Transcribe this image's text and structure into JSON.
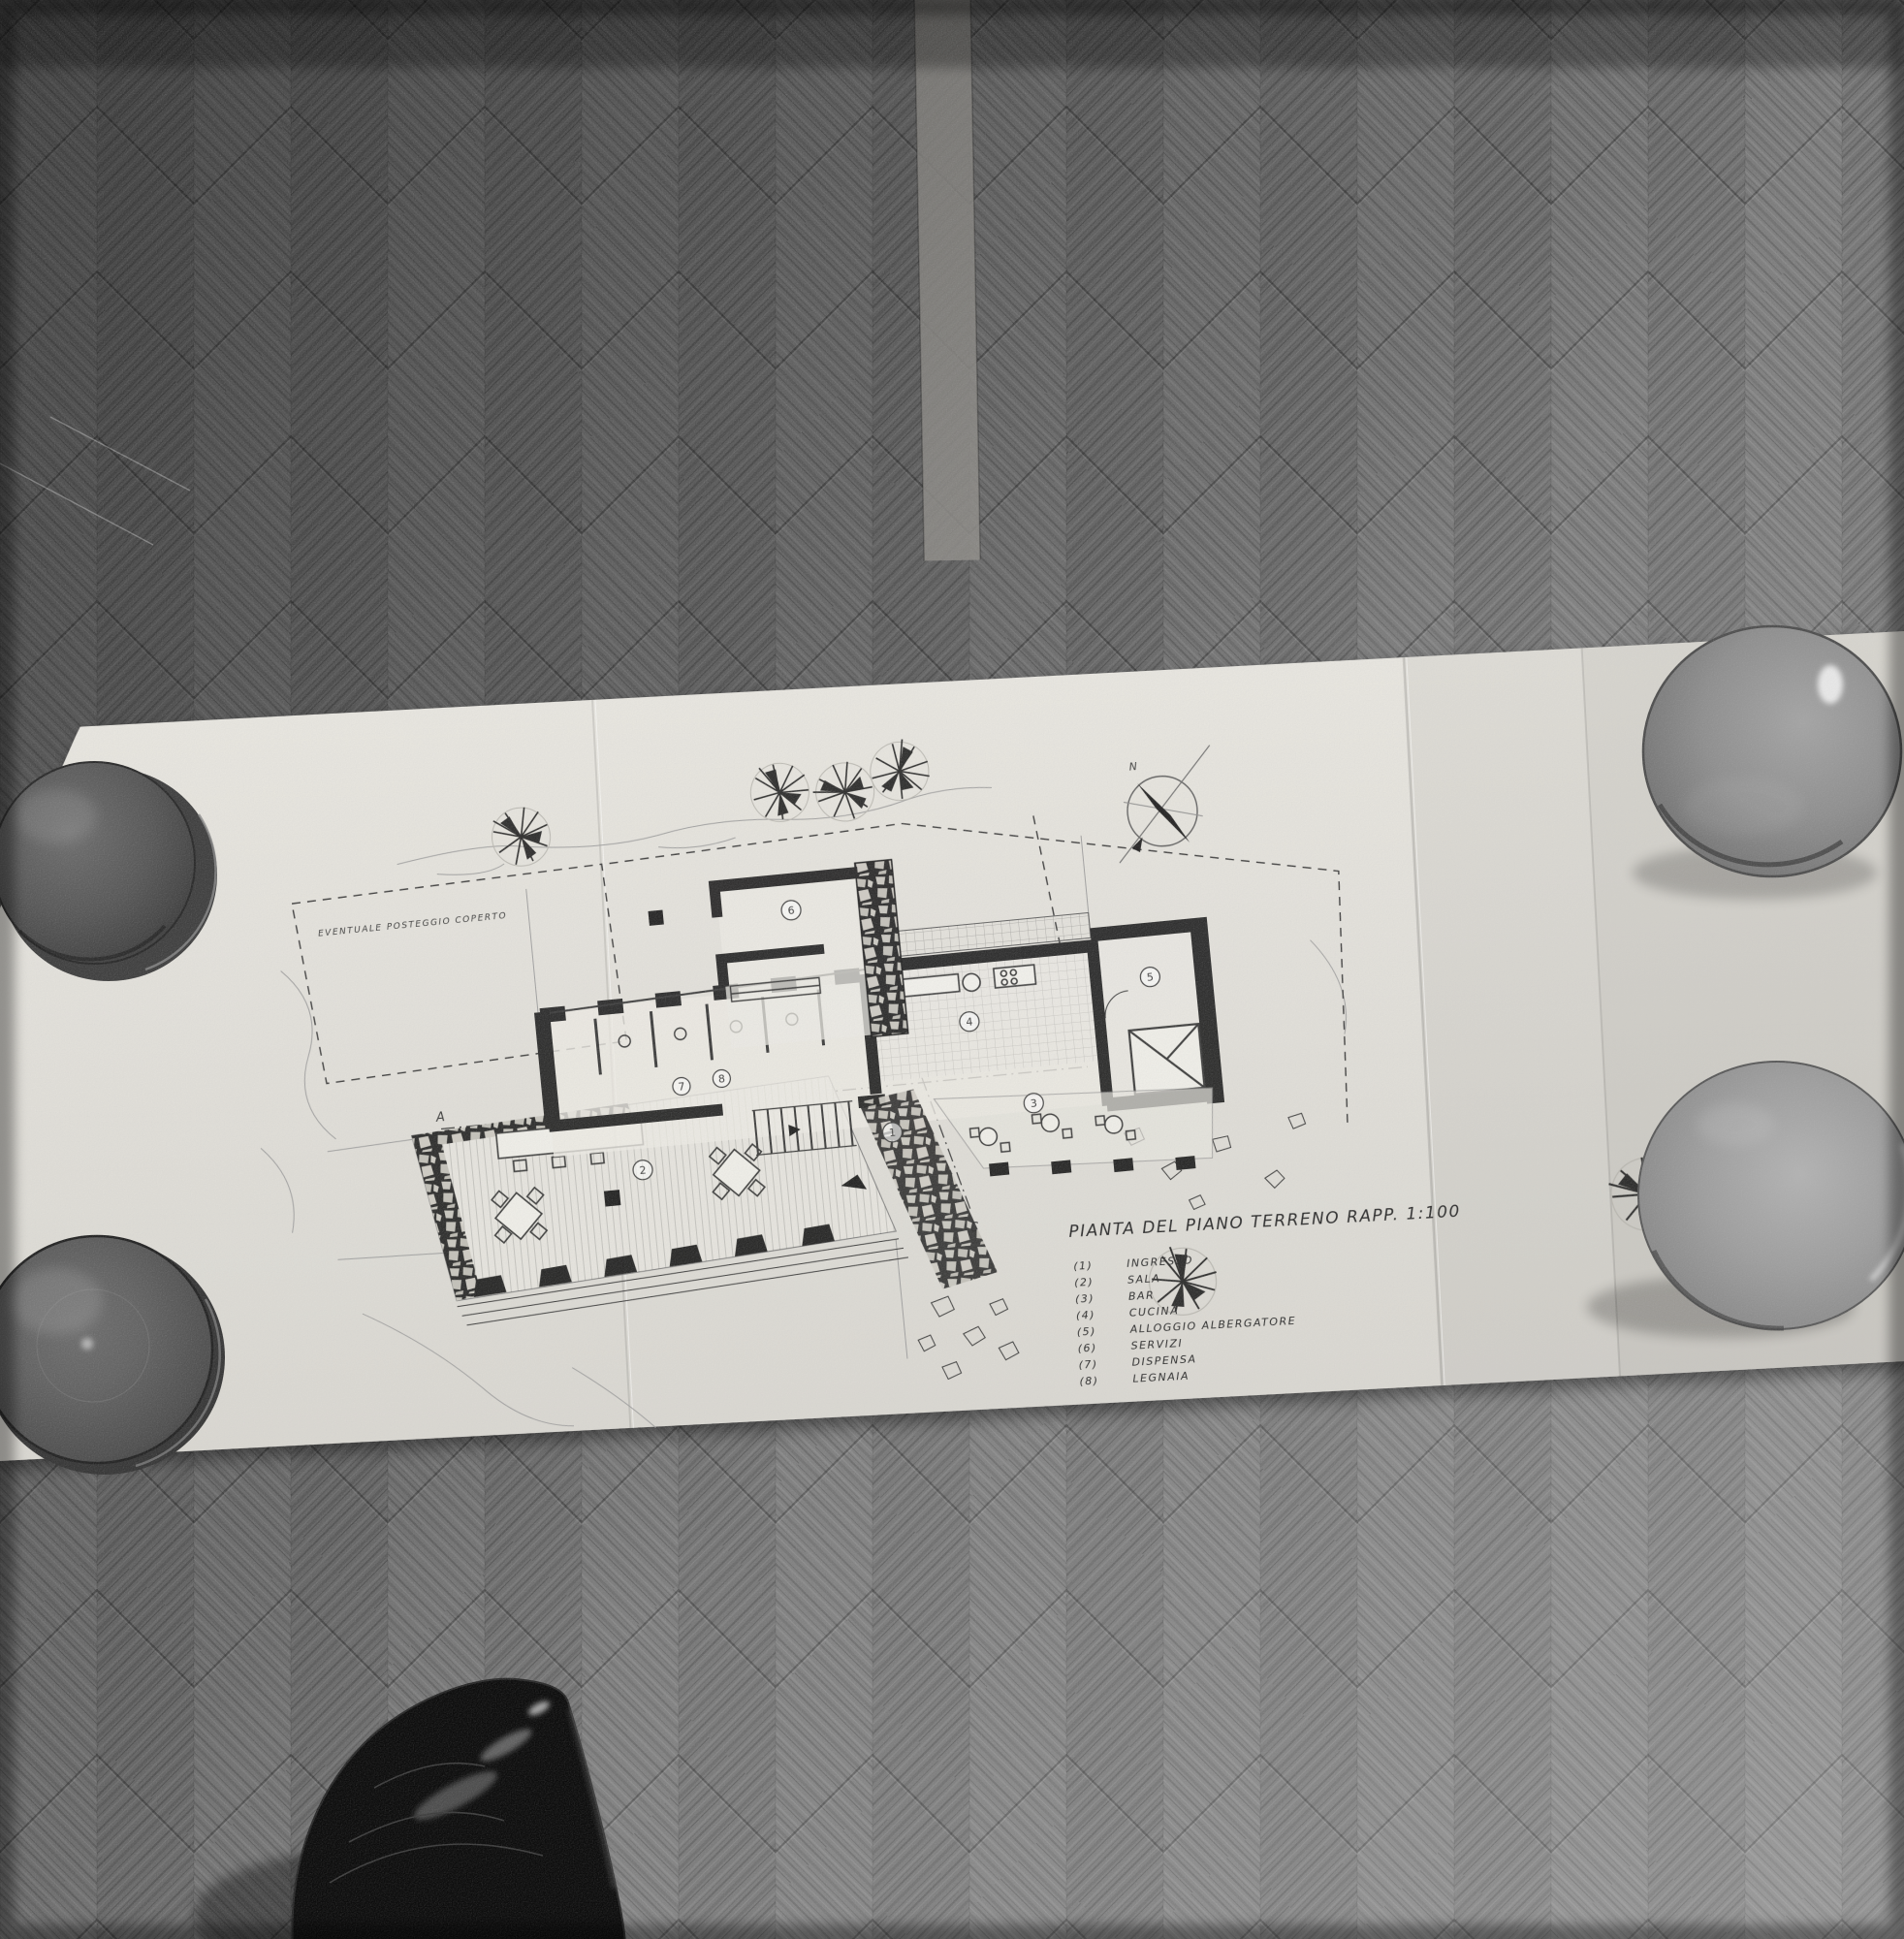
{
  "scene": {
    "description": "Black-and-white photograph, top-down view of an architectural floor-plan drawing unfolded on a herringbone parquet floor, held flat by four glossy ceramic bowls at its corners, with the toe of a black leather shoe at the bottom edge",
    "objects": [
      "floor-plan sheet",
      "herringbone parquet floor",
      "four ceramic bowl paperweights",
      "black leather shoe"
    ]
  },
  "drawing": {
    "title": "PIANTA DEL PIANO TERRENO   RAPP. 1:100",
    "area_label": "EVENTUALE POSTEGGIO COPERTO",
    "compass_north": "N",
    "legend": [
      {
        "number": "(1)",
        "label": "INGRESSO"
      },
      {
        "number": "(2)",
        "label": "SALA"
      },
      {
        "number": "(3)",
        "label": "BAR"
      },
      {
        "number": "(4)",
        "label": "CUCINA"
      },
      {
        "number": "(5)",
        "label": "ALLOGGIO ALBERGATORE"
      },
      {
        "number": "(6)",
        "label": "SERVIZI"
      },
      {
        "number": "(7)",
        "label": "DISPENSA"
      },
      {
        "number": "(8)",
        "label": "LEGNAIA"
      }
    ],
    "room_numbers": [
      "1",
      "2",
      "3",
      "4",
      "5",
      "6",
      "7",
      "8"
    ],
    "section_markers": [
      "A",
      "B",
      "C",
      "D"
    ]
  },
  "palette": {
    "paper": "#e4e2dc",
    "floor_base": "#6e6e6e",
    "ink": "#2e2e2e",
    "bowl_dark": "#4a4a4a",
    "bowl_light": "#9c9c9c",
    "shoe": "#0d0d0d"
  }
}
